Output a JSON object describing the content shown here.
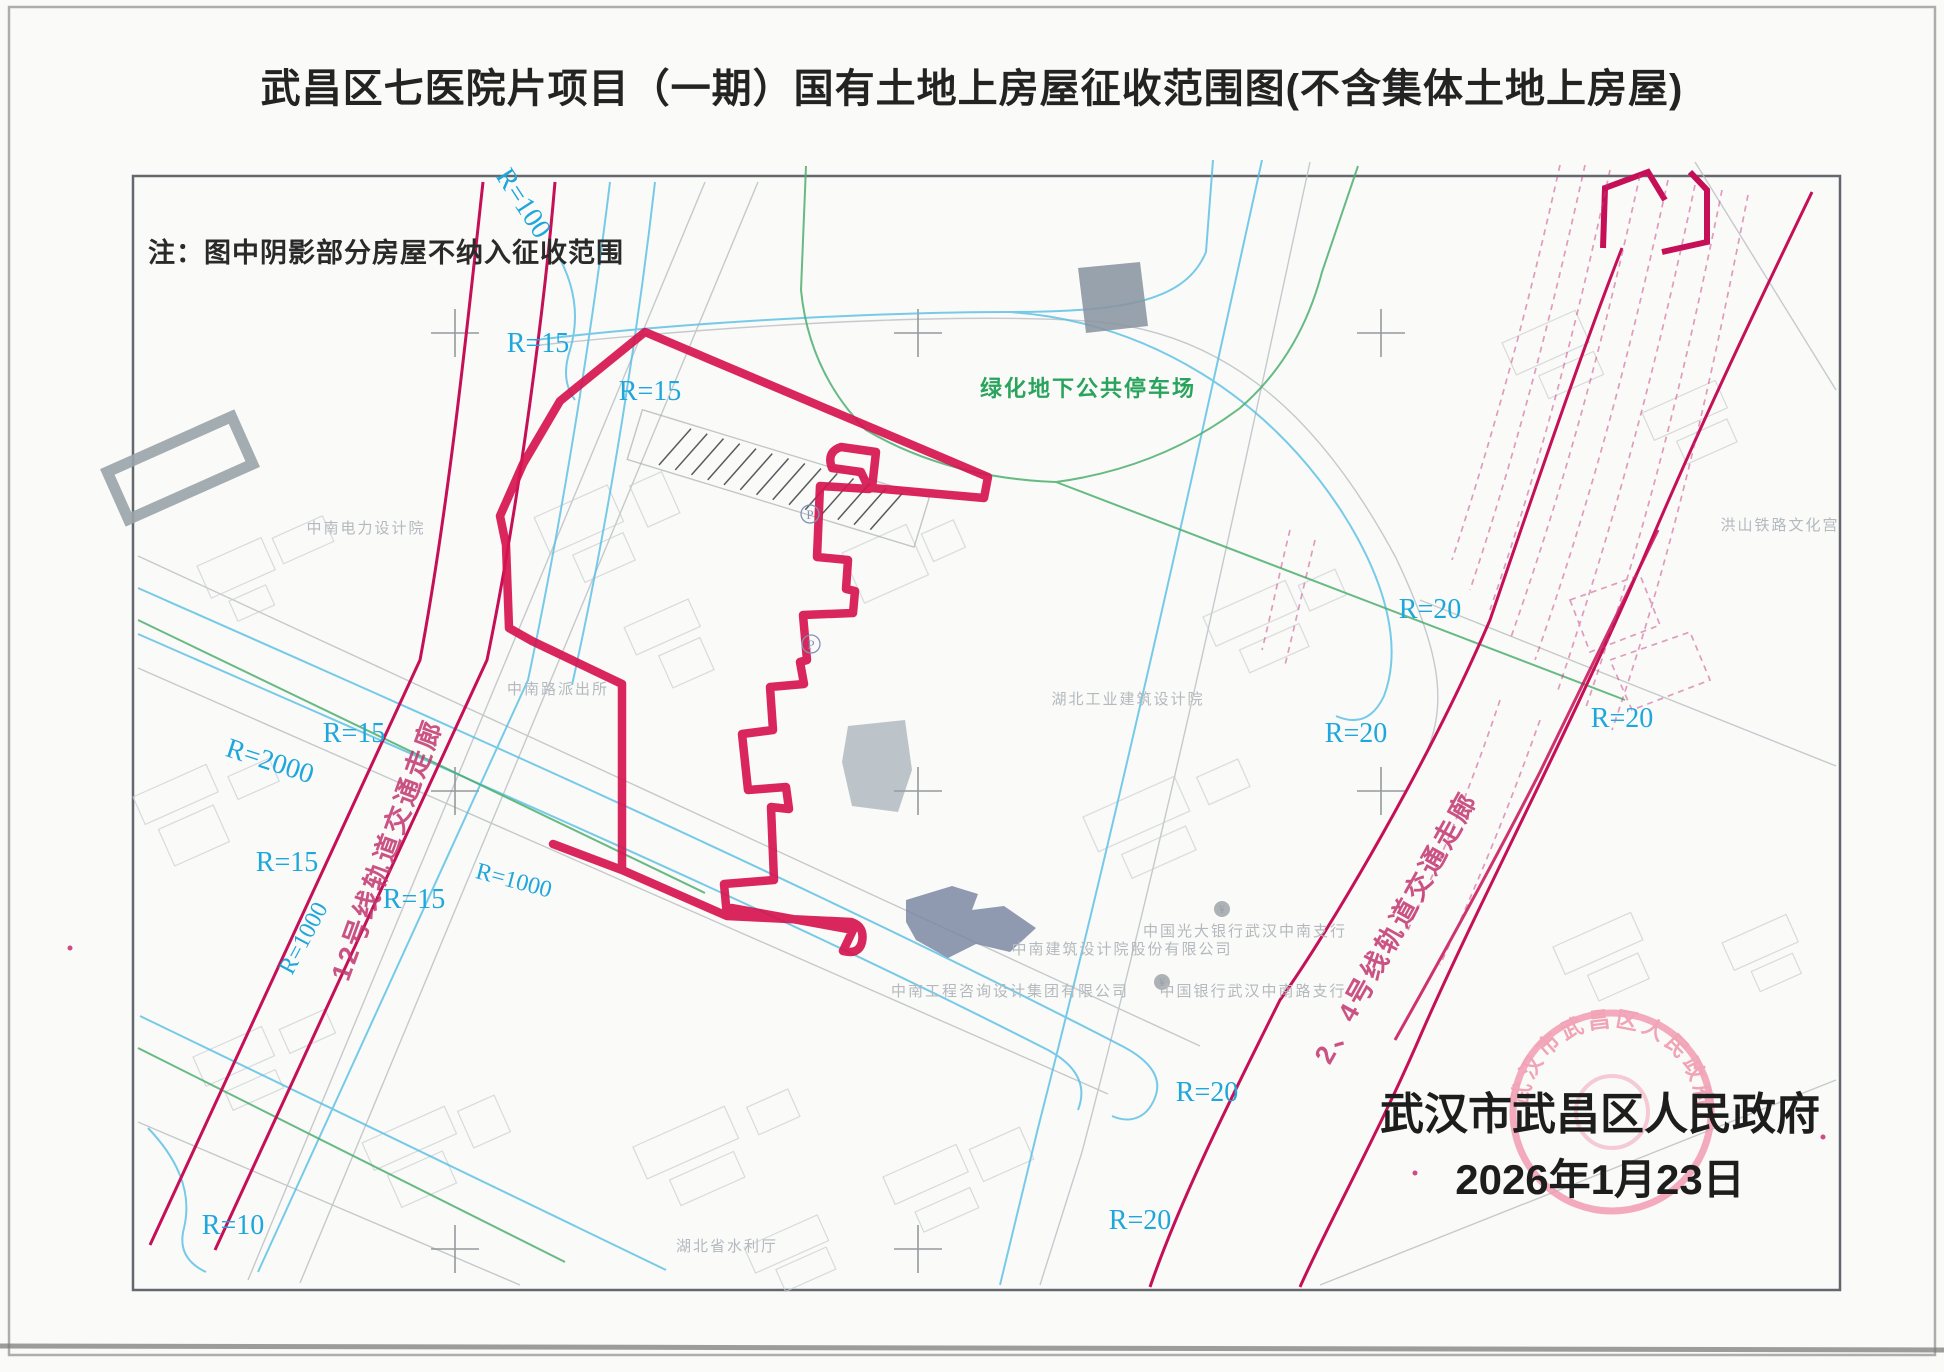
{
  "title": "武昌区七医院片项目（一期）国有土地上房屋征收范围图(不含集体土地上房屋)",
  "note": "注：图中阴影部分房屋不纳入征收范围",
  "signature": {
    "authority": "武汉市武昌区人民政府",
    "date": "2026年1月23日"
  },
  "seal": {
    "text": "武汉市武昌区人民政府"
  },
  "map": {
    "green_label": "绿化地下公共停车场",
    "corridor_labels": [
      "12号线轨道交通走廊",
      "2、4号线轨道交通走廊"
    ],
    "radius_labels": [
      "R=100",
      "R=15",
      "R=15",
      "R=15",
      "R=15",
      "R=15",
      "R=2000",
      "R=1000",
      "R=1000",
      "R=10",
      "R=20",
      "R=20",
      "R=20",
      "R=20",
      "R=20"
    ],
    "building_labels": [
      "中南电力设计院",
      "中南路派出所",
      "湖北工业建筑设计院",
      "中南建筑设计院股份有限公司",
      "中南工程咨询设计集团有限公司",
      "中国光大银行武汉中南支行",
      "中国银行武汉中南路支行",
      "湖北省水利厅",
      "洪山铁路文化宫"
    ],
    "symbols": {
      "parking": "P",
      "yen": "¥"
    },
    "colors": {
      "boundary": "#d6134f",
      "rail_corridor": "#c50f56",
      "road_cyan": "#56bfe4",
      "green": "#4cae6e",
      "seal_pink": "#ee8fa6",
      "shaded_building": "#7b87a3"
    }
  }
}
